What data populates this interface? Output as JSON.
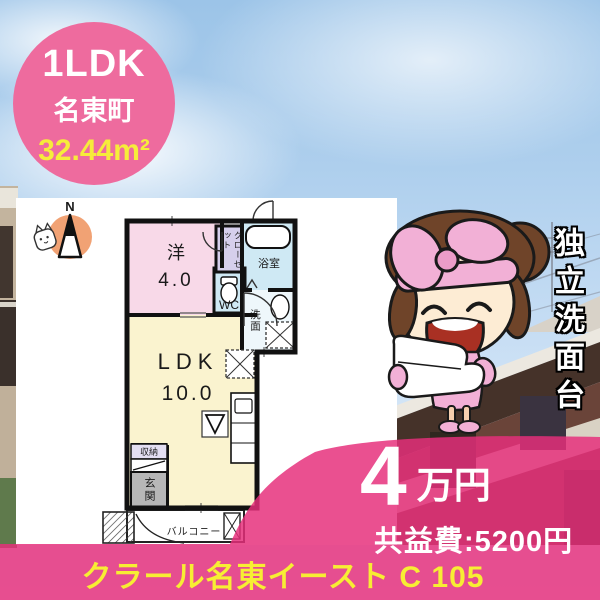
{
  "listing_badge": {
    "layout": "1LDK",
    "town": "名東町",
    "area": "32.44m²"
  },
  "floor_plan": {
    "compass_north": "N",
    "room_western": "洋",
    "room_western_size": "4.0",
    "closet": "クローゼット",
    "bath": "浴室",
    "toilet": "WC",
    "washroom": "洗面",
    "ldk": "LDK",
    "ldk_size": "10.0",
    "storage": "収納",
    "entrance": "玄関",
    "balcony": "バルコニー"
  },
  "feature_caption": "独立洗面台",
  "price": {
    "rent_amount": "4",
    "rent_unit": "万円",
    "common_fee": "共益費:5200円"
  },
  "property_name": "クラール名東イースト C 105",
  "colors": {
    "accent_pink": "#e93e7e",
    "badge_pink": "#ee6b9e",
    "highlight_yellow": "#f7ee33"
  }
}
